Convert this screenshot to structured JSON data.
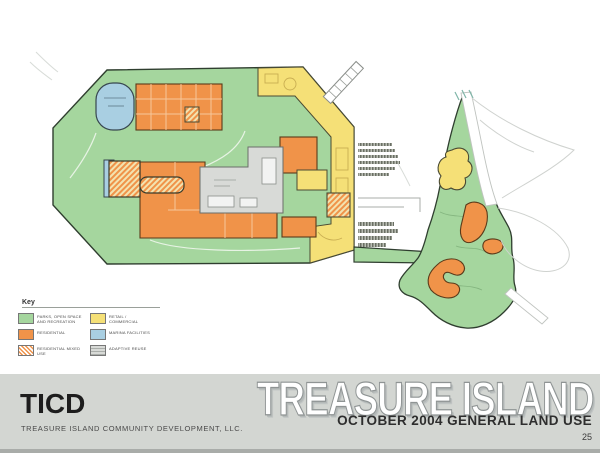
{
  "slide": {
    "kind": "land-use-plan-slide"
  },
  "footer": {
    "logo": "TICD",
    "company": "TREASURE ISLAND COMMUNITY DEVELOPMENT, LLC.",
    "watermark": "TREASURE ISLAND",
    "subtitle": "OCTOBER 2004 GENERAL LAND USE",
    "page": "25"
  },
  "legend": {
    "title": "Key",
    "columns": [
      [
        {
          "label": "PARKS, OPEN SPACE AND RECREATION",
          "swatch": "sw-green"
        },
        {
          "label": "RESIDENTIAL",
          "swatch": "sw-orange"
        },
        {
          "label": "RESIDENTIAL MIXED USE",
          "swatch": "sw-hatch"
        }
      ],
      [
        {
          "label": "RETAIL / COMMERCIAL",
          "swatch": "sw-yellow"
        },
        {
          "label": "MARINA FACILITIES",
          "swatch": "sw-blue"
        },
        {
          "label": "ADAPTIVE REUSE",
          "swatch": "sw-dash"
        }
      ]
    ]
  },
  "map": {
    "islands": [
      "Treasure Island",
      "Yerba Buena Island"
    ]
  },
  "colors": {
    "green": "#a5d69e",
    "greenline": "#33402f",
    "orange": "#f09349",
    "yellow": "#f5e077",
    "blue": "#a9cfe2",
    "gray": "#d8dad7",
    "band": "#d3d6d2",
    "bandedge": "#a9aca9",
    "pier": "#55584f",
    "road": "#cfd2cf",
    "ink": "#1d1d1d"
  }
}
